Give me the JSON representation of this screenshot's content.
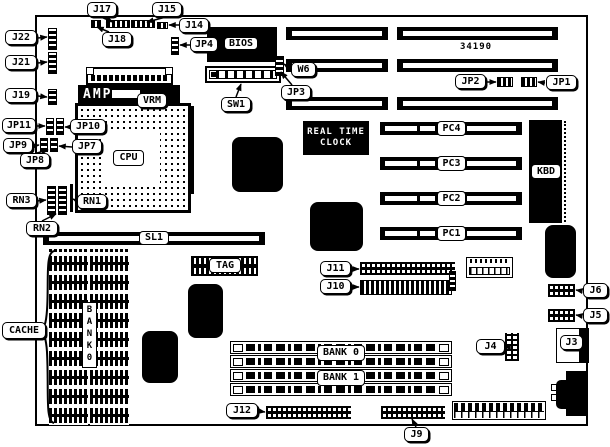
{
  "diagram": {
    "part_number": "34190",
    "callouts": {
      "j17": "J17",
      "j15": "J15",
      "j14": "J14",
      "j18": "J18",
      "jp4": "JP4",
      "j22": "J22",
      "j21": "J21",
      "j19": "J19",
      "jp11": "JP11",
      "jp10": "JP10",
      "jp9": "JP9",
      "jp7": "JP7",
      "jp8": "JP8",
      "rn3": "RN3",
      "rn1": "RN1",
      "rn2": "RN2",
      "vrm": "VRM",
      "sw1": "SW1",
      "w6": "W6",
      "jp3": "JP3",
      "jp2": "JP2",
      "jp1": "JP1",
      "cache": "CACHE",
      "j11": "J11",
      "j10": "J10",
      "j12": "J12",
      "j9": "J9",
      "j4": "J4",
      "j6": "J6",
      "j5": "J5",
      "j3": "J3"
    },
    "chips": {
      "bios": "BIOS",
      "amp": "AMP",
      "cpu": "CPU",
      "kbd": "KBD",
      "tag": "TAG",
      "sl1": "SL1"
    },
    "slots": {
      "pc4": "PC4",
      "pc3": "PC3",
      "pc2": "PC2",
      "pc1": "PC1",
      "bank0": "BANK 0",
      "bank1": "BANK 1",
      "cache_bank": "BANK0"
    },
    "rtc": {
      "line1": "REAL TIME",
      "line2": "CLOCK"
    },
    "colors": {
      "ink": "#000000",
      "paper": "#ffffff"
    }
  }
}
